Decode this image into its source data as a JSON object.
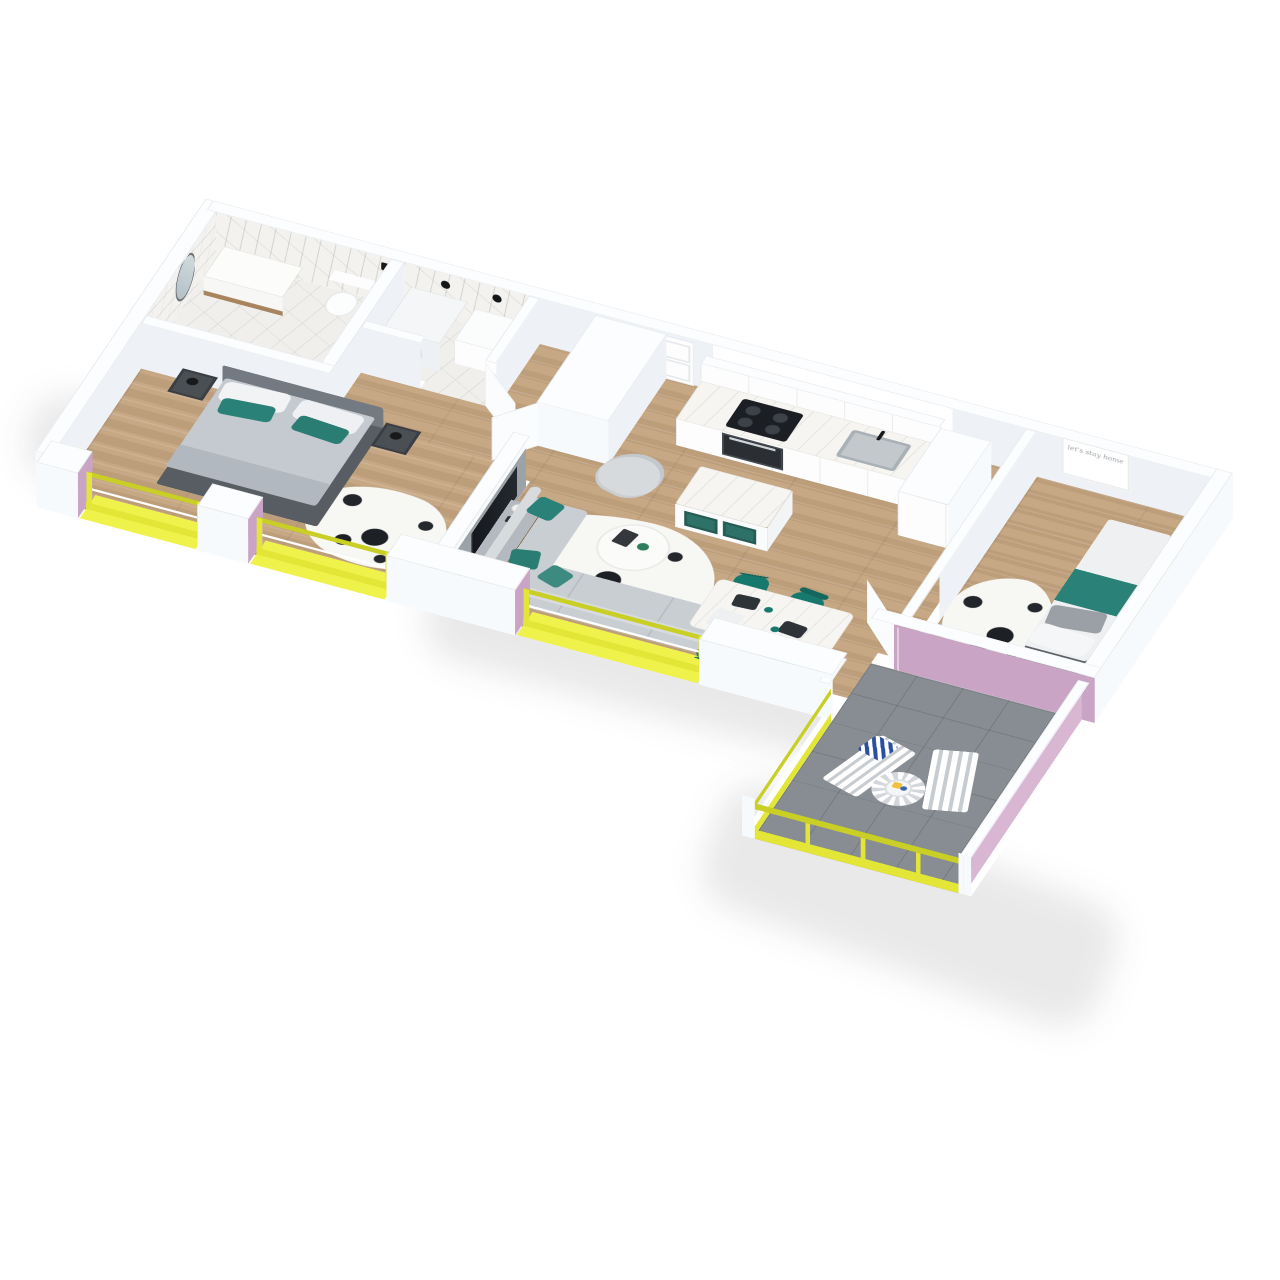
{
  "scene": {
    "type": "isometric-3d-floor-plan",
    "description": "3D cutaway render of a 2-bedroom apartment with wrap balcony, white walls, wood floors, yellow window frames and mauve-pink accent reveals",
    "background": "#ffffff"
  },
  "palette": {
    "yellow": "#e3e637",
    "yellow2": "#c9cf25",
    "yellow3": "#f0f24c",
    "pink": "#c9a4c5",
    "pink2": "#d9b7d3",
    "teal": "#2a8177",
    "teal2": "#17796d",
    "wood": "#c7a885",
    "marble": "#f0efec",
    "tile": "#878d92",
    "wallface": "#eef2f6",
    "wallbright": "#f7fafc",
    "walltop": "#fcfdfe",
    "sofa": "#c9ced3",
    "bed": "#c5cad0",
    "headboard": "#737a81",
    "tv": "#14171b"
  },
  "rooms": [
    {
      "id": "bathroom",
      "finish": "white-marble",
      "items": [
        "round-mirror",
        "vanity",
        "toilet",
        "shower-fixture"
      ]
    },
    {
      "id": "laundry",
      "finish": "white-marble",
      "items": [
        "washing-machine",
        "counter",
        "wall-lamps"
      ]
    },
    {
      "id": "hallway",
      "finish": "wood",
      "items": [
        "entry-door",
        "closet-block"
      ]
    },
    {
      "id": "master-bedroom",
      "finish": "wood",
      "items": [
        "double-bed",
        "nightstand-left",
        "nightstand-right",
        "cowhide-rug"
      ]
    },
    {
      "id": "kitchen",
      "finish": "wood",
      "items": [
        "counter-run",
        "upper-cabinets",
        "cooktop",
        "oven",
        "sink",
        "island-with-teal-shelves",
        "tall-cabinet"
      ]
    },
    {
      "id": "living-dining",
      "finish": "wood",
      "items": [
        "media-wall-tv",
        "console",
        "armchair",
        "coffee-table",
        "corner-sofa",
        "dining-table",
        "dining-chairs",
        "cowhide-rug"
      ]
    },
    {
      "id": "bedroom-2",
      "finish": "wood",
      "items": [
        "single-bed",
        "wall-art",
        "cowhide-rug",
        "yellow-window"
      ]
    },
    {
      "id": "balcony",
      "finish": "gray-tile",
      "items": [
        "lounge-chair-left",
        "lounge-chair-right",
        "round-bistro-table",
        "chevron-pillow"
      ]
    }
  ],
  "bedroom2": {
    "wall_art_text": "let's stay home"
  },
  "counts": {
    "facade_windows": 3,
    "dining_chairs": 4,
    "balcony_chairs": 2,
    "beds": 2,
    "open_doors": 3
  },
  "bedding": {
    "master": [
      "white-pillows",
      "teal-pillows",
      "gray-duvet"
    ],
    "second": [
      "white-duvet",
      "teal-runner",
      "gray-pillow"
    ]
  }
}
